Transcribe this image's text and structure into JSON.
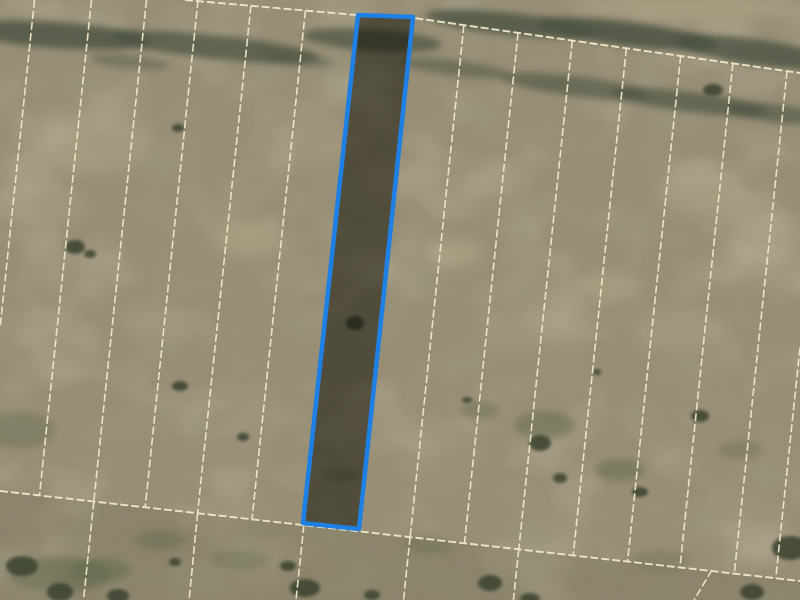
{
  "map": {
    "type": "aerial-parcel-map",
    "size": {
      "width": 800,
      "height": 600
    },
    "colors": {
      "terrain_base": "#998f76",
      "light_patch": "#b8ab8c",
      "green_patch": "#636a4e",
      "shrub": "#3d4433",
      "vegetation": "#4b5342",
      "parcel_line": "#f0e8c9",
      "bottom_shade": "#63644a",
      "highlight_stroke": "#1e80e4",
      "highlight_fill": "rgba(10,9,0,0.5)"
    },
    "terrain": {
      "light_patches": [
        [
          250,
          238,
          35,
          18,
          0.5
        ],
        [
          455,
          253,
          28,
          14,
          0.5
        ],
        [
          610,
          287,
          30,
          15,
          0.45
        ],
        [
          95,
          145,
          55,
          30,
          0.35
        ],
        [
          700,
          190,
          45,
          25,
          0.35
        ],
        [
          230,
          482,
          22,
          10,
          0.4
        ],
        [
          770,
          240,
          40,
          22,
          0.3
        ],
        [
          400,
          180,
          40,
          20,
          0.25
        ],
        [
          40,
          205,
          45,
          22,
          0.3
        ],
        [
          320,
          140,
          45,
          22,
          0.25
        ],
        [
          520,
          330,
          40,
          20,
          0.25
        ],
        [
          680,
          330,
          45,
          22,
          0.3
        ],
        [
          150,
          320,
          30,
          15,
          0.25
        ],
        [
          690,
          8,
          120,
          12,
          0.5
        ]
      ],
      "veg_bands": [
        [
          55,
          35,
          95,
          13,
          0.8,
          4
        ],
        [
          215,
          47,
          105,
          12,
          0.75,
          6
        ],
        [
          372,
          40,
          70,
          11,
          0.7,
          4
        ],
        [
          510,
          24,
          85,
          11,
          0.8,
          6
        ],
        [
          628,
          34,
          90,
          12,
          0.85,
          7
        ],
        [
          755,
          52,
          80,
          13,
          0.8,
          8
        ],
        [
          455,
          68,
          55,
          8,
          0.5,
          7
        ],
        [
          575,
          86,
          75,
          10,
          0.6,
          7
        ],
        [
          690,
          102,
          80,
          10,
          0.65,
          7
        ],
        [
          780,
          114,
          55,
          9,
          0.6,
          7
        ],
        [
          130,
          62,
          40,
          7,
          0.4,
          6
        ],
        [
          300,
          60,
          35,
          6,
          0.4,
          6
        ]
      ],
      "green_patches": [
        [
          545,
          425,
          30,
          14,
          0.5
        ],
        [
          480,
          410,
          20,
          9,
          0.45
        ],
        [
          620,
          470,
          25,
          11,
          0.5
        ],
        [
          160,
          540,
          25,
          10,
          0.45
        ],
        [
          340,
          475,
          20,
          8,
          0.4
        ],
        [
          100,
          570,
          30,
          12,
          0.55
        ],
        [
          20,
          430,
          35,
          18,
          0.4
        ],
        [
          60,
          575,
          50,
          18,
          0.5
        ],
        [
          240,
          560,
          30,
          10,
          0.35
        ],
        [
          430,
          545,
          25,
          9,
          0.35
        ],
        [
          660,
          560,
          30,
          10,
          0.3
        ],
        [
          740,
          450,
          22,
          9,
          0.35
        ]
      ],
      "shrubs": [
        [
          178,
          128,
          6,
          4
        ],
        [
          75,
          247,
          10,
          7
        ],
        [
          90,
          254,
          6,
          4
        ],
        [
          180,
          386,
          8,
          5
        ],
        [
          243,
          437,
          6,
          4
        ],
        [
          467,
          400,
          5,
          3
        ],
        [
          597,
          372,
          4,
          3
        ],
        [
          540,
          443,
          11,
          8
        ],
        [
          560,
          478,
          7,
          5
        ],
        [
          640,
          492,
          8,
          5
        ],
        [
          700,
          416,
          9,
          6
        ],
        [
          713,
          90,
          10,
          6
        ],
        [
          790,
          548,
          18,
          12
        ],
        [
          752,
          592,
          12,
          8
        ],
        [
          22,
          566,
          16,
          10
        ],
        [
          60,
          592,
          13,
          9
        ],
        [
          118,
          596,
          11,
          7
        ],
        [
          305,
          588,
          15,
          9
        ],
        [
          288,
          566,
          8,
          5
        ],
        [
          490,
          583,
          12,
          8
        ],
        [
          530,
          599,
          10,
          6
        ],
        [
          175,
          562,
          6,
          4
        ],
        [
          372,
          595,
          8,
          5
        ],
        [
          355,
          323,
          9,
          7
        ]
      ]
    },
    "parcels": {
      "grid_segments": [
        [
          34.5,
          0,
          0,
          328.6
        ],
        [
          91.5,
          0,
          39.5,
          495.4
        ],
        [
          146.5,
          0,
          93.8,
          501.5
        ],
        [
          198,
          0,
          145.2,
          507.3
        ],
        [
          250.9,
          5.8,
          197.6,
          513.2
        ],
        [
          305.4,
          10.6,
          252,
          519.2
        ],
        [
          463.9,
          25.1,
          410.1,
          536.9
        ],
        [
          518.1,
          32.7,
          464.5,
          543
        ],
        [
          572.3,
          40.4,
          518.8,
          549.1
        ],
        [
          626.4,
          48.1,
          573.2,
          555.2
        ],
        [
          680.7,
          55.7,
          627.6,
          561.3
        ],
        [
          732.9,
          63.1,
          680,
          567.2
        ],
        [
          787.1,
          70.8,
          734.3,
          573.3
        ],
        [
          800,
          347.6,
          775.8,
          577.9
        ],
        [
          93.8,
          501.5,
          83.5,
          600
        ],
        [
          197.6,
          513.2,
          189.1,
          600
        ],
        [
          303.9,
          525,
          296,
          600
        ],
        [
          410.1,
          536.9,
          403.5,
          600
        ],
        [
          518.8,
          549.1,
          513.4,
          600
        ],
        [
          712,
          570,
          694,
          600
        ]
      ],
      "boundary_top": [
        [
          185,
          0
        ],
        [
          356,
          15
        ],
        [
          414,
          18
        ],
        [
          800,
          73
        ]
      ],
      "boundary_bottom": [
        [
          0,
          491
        ],
        [
          800,
          581
        ]
      ],
      "line_width": 1.6,
      "boundary_width": 1.9,
      "dash": "8 3"
    },
    "bottom_shade_polygon": [
      [
        0,
        491
      ],
      [
        800,
        581
      ],
      [
        800,
        600
      ],
      [
        0,
        600
      ]
    ],
    "bottom_shade_opacity": 0.22,
    "highlighted_parcel": {
      "points": [
        [
          358,
          15
        ],
        [
          413,
          17
        ],
        [
          359,
          529
        ],
        [
          303,
          523
        ]
      ],
      "stroke_width": 4.5
    }
  }
}
